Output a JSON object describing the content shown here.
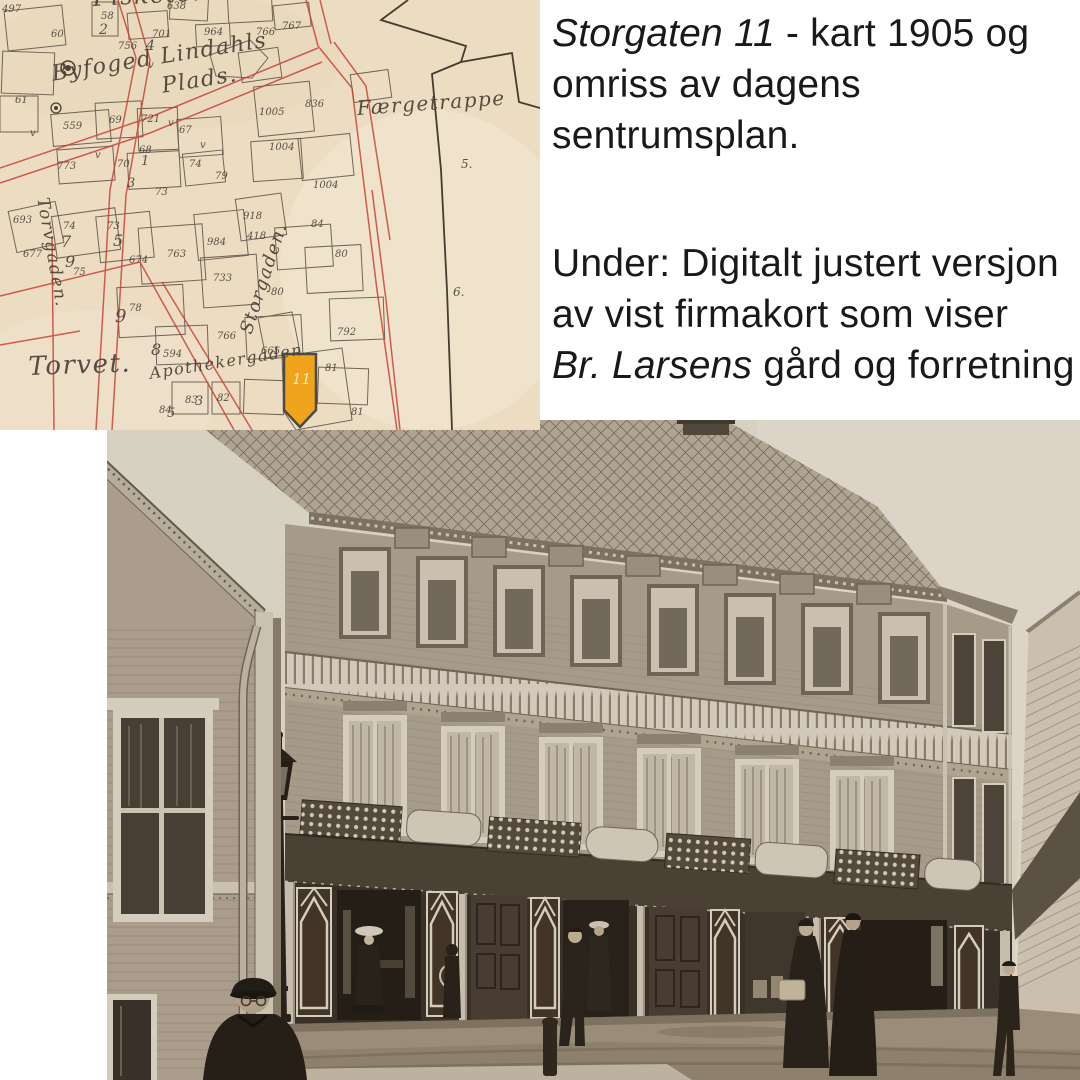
{
  "page": {
    "background": "#ffffff"
  },
  "caption_top": {
    "italic": "Storgaten 11",
    "rest": " - kart 1905 og",
    "line2": "omriss av dagens",
    "line3": "sentrumsplan."
  },
  "caption_bottom": {
    "line1": "Under: Digitalt justert versjon",
    "line2": "av vist firmakort som viser",
    "line3_italic": "Br. Larsens",
    "line3_rest": " gård og forretning"
  },
  "map": {
    "street_labels": [
      {
        "text": "Fisketorvet",
        "x": 92,
        "y": -16,
        "size": 24,
        "rot": -3
      },
      {
        "text": "Byfoged Lindahls",
        "x": 50,
        "y": 62,
        "size": 22,
        "rot": -9
      },
      {
        "text": "Plads.",
        "x": 160,
        "y": 74,
        "size": 22,
        "rot": -9
      },
      {
        "text": "Færgetrappe",
        "x": 356,
        "y": 96,
        "size": 20,
        "rot": -4
      },
      {
        "text": "Torvgaden.",
        "x": 52,
        "y": 196,
        "size": 17,
        "rot": 80
      },
      {
        "text": "Storgaden.",
        "x": 236,
        "y": 330,
        "size": 18,
        "rot": -72
      },
      {
        "text": "Torvet.",
        "x": 28,
        "y": 352,
        "size": 26,
        "rot": -2
      },
      {
        "text": "Apothekergaden",
        "x": 148,
        "y": 364,
        "size": 16,
        "rot": -9
      }
    ],
    "plot_numbers": [
      {
        "t": "497",
        "x": 2,
        "y": 4
      },
      {
        "t": "58",
        "x": 101,
        "y": 11
      },
      {
        "t": "2",
        "x": 99,
        "y": 22,
        "s": 14
      },
      {
        "t": "638",
        "x": 167,
        "y": 1
      },
      {
        "t": "60",
        "x": 51,
        "y": 29
      },
      {
        "t": "756",
        "x": 118,
        "y": 41
      },
      {
        "t": "701",
        "x": 152,
        "y": 29
      },
      {
        "t": "4",
        "x": 146,
        "y": 38,
        "s": 14
      },
      {
        "t": "964",
        "x": 204,
        "y": 27
      },
      {
        "t": "766",
        "x": 256,
        "y": 27
      },
      {
        "t": "767",
        "x": 282,
        "y": 21
      },
      {
        "t": "61",
        "x": 15,
        "y": 95
      },
      {
        "t": "559",
        "x": 63,
        "y": 121
      },
      {
        "t": "69",
        "x": 109,
        "y": 115
      },
      {
        "t": "721",
        "x": 141,
        "y": 114
      },
      {
        "t": "67",
        "x": 179,
        "y": 125
      },
      {
        "t": "68",
        "x": 139,
        "y": 145
      },
      {
        "t": "1",
        "x": 141,
        "y": 154,
        "s": 13
      },
      {
        "t": "70",
        "x": 117,
        "y": 159
      },
      {
        "t": "3",
        "x": 127,
        "y": 176,
        "s": 13
      },
      {
        "t": "74",
        "x": 189,
        "y": 159
      },
      {
        "t": "79",
        "x": 215,
        "y": 171
      },
      {
        "t": "73",
        "x": 155,
        "y": 187
      },
      {
        "t": "773",
        "x": 57,
        "y": 161
      },
      {
        "t": "693",
        "x": 13,
        "y": 215
      },
      {
        "t": "677",
        "x": 23,
        "y": 249
      },
      {
        "t": "74",
        "x": 63,
        "y": 221
      },
      {
        "t": "7",
        "x": 61,
        "y": 232,
        "s": 16
      },
      {
        "t": "73",
        "x": 107,
        "y": 221
      },
      {
        "t": "5",
        "x": 113,
        "y": 231,
        "s": 16
      },
      {
        "t": "9",
        "x": 65,
        "y": 252,
        "s": 16
      },
      {
        "t": "75",
        "x": 73,
        "y": 267
      },
      {
        "t": "674",
        "x": 129,
        "y": 255
      },
      {
        "t": "763",
        "x": 167,
        "y": 249
      },
      {
        "t": "984",
        "x": 207,
        "y": 237
      },
      {
        "t": "918",
        "x": 243,
        "y": 211
      },
      {
        "t": "418",
        "x": 247,
        "y": 231
      },
      {
        "t": "733",
        "x": 213,
        "y": 273
      },
      {
        "t": "78",
        "x": 129,
        "y": 303
      },
      {
        "t": "9",
        "x": 115,
        "y": 306,
        "s": 18
      },
      {
        "t": "766",
        "x": 217,
        "y": 331
      },
      {
        "t": "8",
        "x": 151,
        "y": 340,
        "s": 16
      },
      {
        "t": "594",
        "x": 163,
        "y": 349
      },
      {
        "t": "1005",
        "x": 259,
        "y": 107
      },
      {
        "t": "836",
        "x": 305,
        "y": 99
      },
      {
        "t": "1004",
        "x": 269,
        "y": 142
      },
      {
        "t": "1004",
        "x": 313,
        "y": 180
      },
      {
        "t": "84",
        "x": 311,
        "y": 219
      },
      {
        "t": "80",
        "x": 335,
        "y": 249
      },
      {
        "t": "80",
        "x": 271,
        "y": 287
      },
      {
        "t": "792",
        "x": 337,
        "y": 327
      },
      {
        "t": "665",
        "x": 261,
        "y": 346
      },
      {
        "t": "81",
        "x": 325,
        "y": 363
      },
      {
        "t": "81",
        "x": 351,
        "y": 407
      },
      {
        "t": "83",
        "x": 185,
        "y": 395
      },
      {
        "t": "3",
        "x": 195,
        "y": 394,
        "s": 13
      },
      {
        "t": "82",
        "x": 217,
        "y": 393
      },
      {
        "t": "84",
        "x": 159,
        "y": 405
      },
      {
        "t": "5",
        "x": 167,
        "y": 406,
        "s": 13
      },
      {
        "t": "5.",
        "x": 461,
        "y": 157,
        "s": 12
      },
      {
        "t": "6.",
        "x": 453,
        "y": 285,
        "s": 12
      },
      {
        "t": "v",
        "x": 148,
        "y": 60
      },
      {
        "t": "v",
        "x": 30,
        "y": 128
      },
      {
        "t": "v",
        "x": 95,
        "y": 150
      },
      {
        "t": "v",
        "x": 168,
        "y": 118
      },
      {
        "t": "v",
        "x": 200,
        "y": 140
      }
    ],
    "highlight_plot": {
      "label": "11",
      "color": "#f0a41c"
    },
    "colors": {
      "paper": "#ecdcc2",
      "street_red": "#c94437",
      "ink": "#5b5044",
      "outline_black": "#453c31"
    }
  },
  "photo": {
    "colors": {
      "sky": "#dcd6c9",
      "wall": "#a89c8c",
      "trim": "#d9d1c3",
      "storefront": "#352d25",
      "street": "#9c8e7c",
      "figures": "#241e18"
    }
  }
}
